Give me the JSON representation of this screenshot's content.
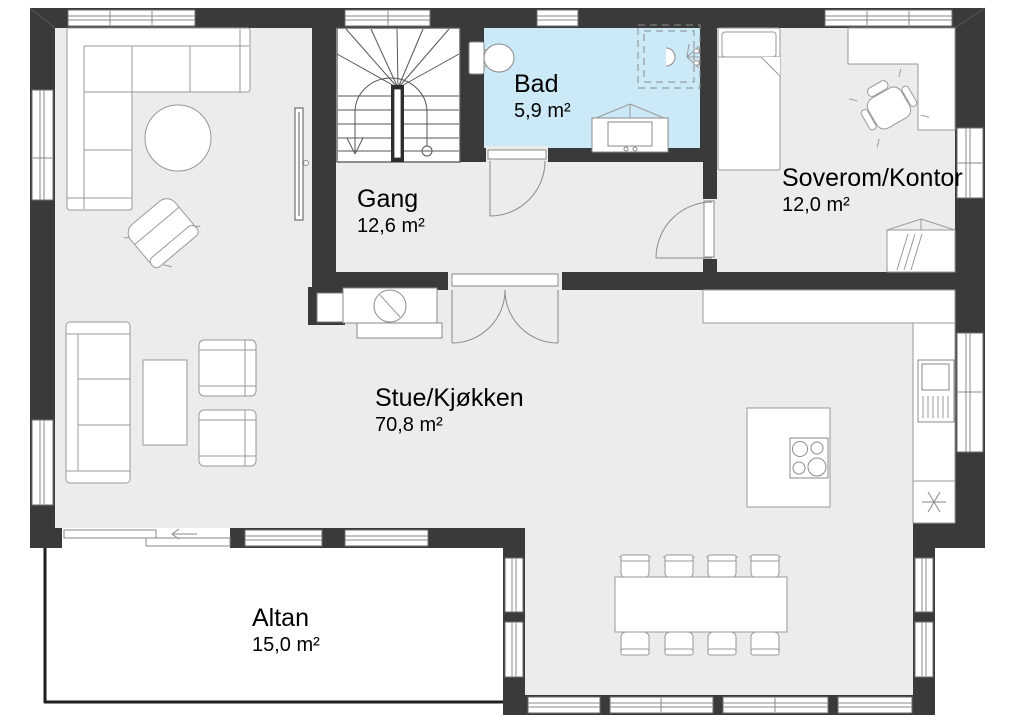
{
  "plan": {
    "type": "floor-plan",
    "colors": {
      "wall": "#3a3a3a",
      "floor": "#ececec",
      "bath": "#cbe9f6",
      "altan": "#ffffff",
      "line": "#999999",
      "text": "#000000"
    },
    "rooms": [
      {
        "id": "bad",
        "name": "Bad",
        "area": "5,9 m²"
      },
      {
        "id": "gang",
        "name": "Gang",
        "area": "12,6 m²"
      },
      {
        "id": "soverom",
        "name": "Soverom/Kontor",
        "area": "12,0 m²"
      },
      {
        "id": "stue",
        "name": "Stue/Kjøkken",
        "area": "70,8 m²"
      },
      {
        "id": "altan",
        "name": "Altan",
        "area": "15,0 m²"
      }
    ]
  }
}
